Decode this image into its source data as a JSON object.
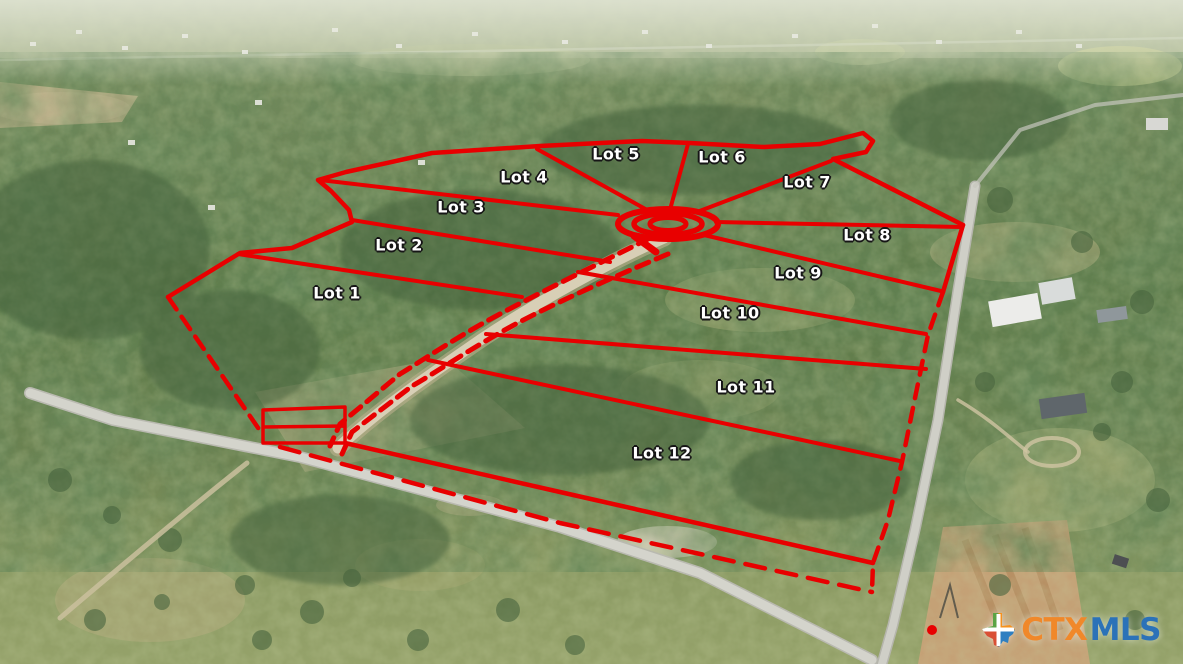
{
  "image": {
    "description": "Aerial drone photograph of wooded acreage outlined in red and subdivided into 12 lots around a central cul-de-sac, bordered by country roads",
    "kind": "real-estate-lot-map-photo"
  },
  "overlay": {
    "line_color": "#e80000",
    "label_color": "#ffffff",
    "label_outline_color": "#161616"
  },
  "lots": [
    {
      "label": "Lot 1",
      "x": 337,
      "y": 293
    },
    {
      "label": "Lot 2",
      "x": 399,
      "y": 245
    },
    {
      "label": "Lot 3",
      "x": 461,
      "y": 207
    },
    {
      "label": "Lot 4",
      "x": 524,
      "y": 177
    },
    {
      "label": "Lot 5",
      "x": 616,
      "y": 154
    },
    {
      "label": "Lot 6",
      "x": 722,
      "y": 157
    },
    {
      "label": "Lot 7",
      "x": 807,
      "y": 182
    },
    {
      "label": "Lot 8",
      "x": 867,
      "y": 235
    },
    {
      "label": "Lot 9",
      "x": 798,
      "y": 273
    },
    {
      "label": "Lot 10",
      "x": 730,
      "y": 313
    },
    {
      "label": "Lot 11",
      "x": 746,
      "y": 387
    },
    {
      "label": "Lot 12",
      "x": 662,
      "y": 453
    }
  ],
  "watermark": {
    "prefix": "CTX",
    "suffix": "MLS",
    "prefix_color": "#f0882a",
    "suffix_color": "#2b72b8",
    "icon": "texas-state-plus-icon",
    "icon_colors": {
      "top_left": "#5ba345",
      "top_right": "#f6921e",
      "bottom_left": "#d94f35",
      "bottom_right": "#2f7fc1",
      "cross": "#ffffff"
    }
  }
}
